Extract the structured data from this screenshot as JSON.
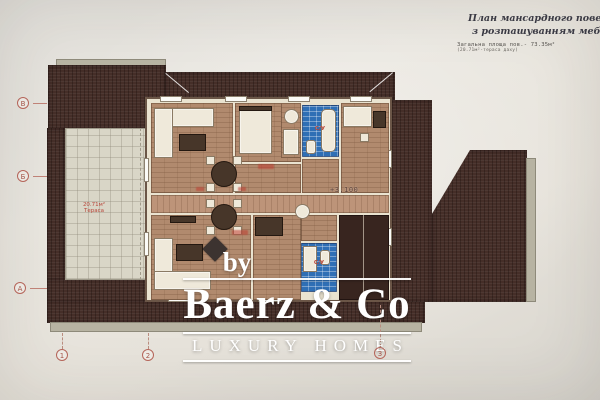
{
  "document": {
    "title_line1": "План мансардного поверху",
    "title_line2": "з розташуванням меблів М 1:",
    "area_line1": "Загальна площа пов.- 73.35м²",
    "area_line2": "(20.71м²-тераса даху)"
  },
  "plan": {
    "terrace_area": "20.71м²",
    "terrace_name": "Тераса",
    "elevation": "+3,100",
    "bathroom_abbr": "С/У",
    "axis_rows": [
      "В",
      "Б",
      "А"
    ],
    "axis_cols": [
      "1",
      "2",
      "3"
    ]
  },
  "watermark": {
    "by": "by",
    "brand": "Baerz & Co",
    "tagline": "LUXURY HOMES"
  },
  "colors": {
    "roof": "#452e28",
    "terrace": "#d9d6c7",
    "floor_parquet": "#b18a6e",
    "bath_tile": "#2f6fb5",
    "annotation_red": "#b8463a",
    "watermark": "#ffffff",
    "paper": "#e7e4dd"
  }
}
